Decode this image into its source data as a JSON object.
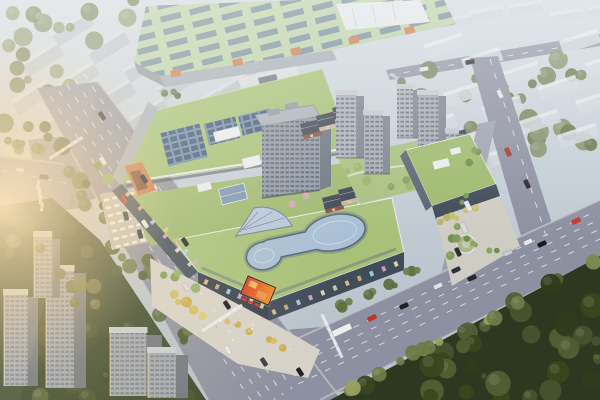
{
  "meta": {
    "description": "Aerial architectural rendering of a mixed-use commercial complex: green-roofed shopping mall with rooftop solar arrays and curved glass skylight, mid-rise residential towers, European-style retail street, tree-lined avenues with traffic, industrial building behind, hazy city blocks in the distance, dense forest in the foreground and warm sun flare from the left",
    "width": 600,
    "height": 400
  },
  "colors": {
    "sky_top": "#ced7df",
    "sky_bottom": "#b5bfc7",
    "road": "#8d90a0",
    "lane_mark": "#eef0f3",
    "sidewalk": "#c2c5cd",
    "mall_green": "#a2be72",
    "mall_green2": "#a7c178",
    "mall_green3": "#9db86e",
    "factory_green": "#b8cfa3",
    "solar_dark": "#2f4866",
    "glass": "#a9bfd4",
    "glass_frame": "#55667c",
    "facade_dark": "#38414d",
    "facade_mid": "#454f5c",
    "facade_light": "#9fa9b1",
    "accent_orange": "#c9774a",
    "led_red": "#d8401f",
    "led_orange": "#e98f2e",
    "led_text": "#d93425",
    "tower_face": "#8f98a4",
    "tower_side": "#6c7480",
    "tower_roof": "#a8afb8",
    "window": "#525a68",
    "bg_slab": "#b6c0c8",
    "bg_slab_top": "#d4dbe1",
    "bg_slab_tr": "#cfd7dd",
    "forest_base": "#2d3820",
    "bl_base": "#39462a",
    "plaza": "#d6d2c8",
    "plaza_east": "#cfccc3",
    "parking": "#c4bfb4",
    "podium_green": "#9cb96d",
    "courtyard": "#a9bf80",
    "brick": "#8a4f47",
    "slate": "#3e4553",
    "cream": "#c3b7a4",
    "pink": "#d4a4be",
    "wall": "#c6cdd3",
    "white_bldg": "#e0e4e7",
    "connector": "#d6dadd",
    "service": "#a7afb7",
    "flare": "#ffe6b8",
    "et_face": "#adb2ba",
    "et_side": "#7e848d",
    "et_top": "#c2c7cd",
    "blt_face": "#a2a8b0",
    "blt_side": "#6e747d",
    "blt_top": "#c9cdd2"
  },
  "solar_arrays": [
    [
      164,
      128,
      40,
      34
    ],
    [
      206,
      120,
      32,
      22
    ],
    [
      240,
      112,
      32,
      20
    ]
  ],
  "factory_accents": [
    [
      170,
      71
    ],
    [
      232,
      60
    ],
    [
      290,
      49
    ],
    [
      348,
      38
    ],
    [
      404,
      28
    ]
  ],
  "bg_slabs_tl": [
    [
      52,
      36
    ],
    [
      88,
      54
    ],
    [
      124,
      72
    ],
    [
      158,
      90
    ],
    [
      22,
      66
    ],
    [
      58,
      86
    ],
    [
      94,
      104
    ],
    [
      128,
      122
    ],
    [
      12,
      104
    ],
    [
      46,
      124
    ],
    [
      82,
      142
    ],
    [
      116,
      160
    ],
    [
      152,
      56
    ],
    [
      186,
      74
    ],
    [
      190,
      108
    ],
    [
      222,
      124
    ],
    [
      218,
      92
    ],
    [
      164,
      140
    ]
  ],
  "bg_slabs_tr": [
    [
      424,
      48
    ],
    [
      462,
      62
    ],
    [
      500,
      76
    ],
    [
      538,
      90
    ],
    [
      576,
      104
    ],
    [
      444,
      96
    ],
    [
      482,
      110
    ],
    [
      520,
      124
    ],
    [
      558,
      138
    ],
    [
      416,
      128
    ],
    [
      452,
      142
    ],
    [
      490,
      156
    ],
    [
      586,
      66
    ],
    [
      560,
      44
    ]
  ],
  "bg_slabs_far": [
    [
      470,
      14
    ],
    [
      510,
      8
    ],
    [
      550,
      16
    ],
    [
      588,
      10
    ],
    [
      440,
      22
    ]
  ],
  "bl_towers": [
    {
      "x": 4,
      "y": 294,
      "w": 34,
      "h": 92
    },
    {
      "x": 46,
      "y": 270,
      "w": 40,
      "h": 118
    },
    {
      "x": 110,
      "y": 332,
      "w": 52,
      "h": 64
    },
    {
      "x": 34,
      "y": 236,
      "w": 26,
      "h": 62
    },
    {
      "x": 148,
      "y": 352,
      "w": 40,
      "h": 46
    }
  ],
  "east_towers": [
    {
      "x": 336,
      "y": 94,
      "w": 28,
      "h": 64
    },
    {
      "x": 364,
      "y": 114,
      "w": 26,
      "h": 60
    },
    {
      "x": 397,
      "y": 88,
      "w": 22,
      "h": 50
    },
    {
      "x": 418,
      "y": 94,
      "w": 28,
      "h": 62
    },
    {
      "x": 446,
      "y": 132,
      "w": 18,
      "h": 44
    }
  ],
  "euro_retail": [
    [
      300,
      124
    ],
    [
      316,
      116
    ],
    [
      332,
      108
    ],
    [
      322,
      198
    ],
    [
      338,
      190
    ],
    [
      352,
      182
    ],
    [
      368,
      174
    ],
    [
      384,
      166
    ],
    [
      400,
      158
    ],
    [
      416,
      150
    ],
    [
      432,
      142
    ],
    [
      446,
      134
    ]
  ],
  "pink_trees": [
    [
      348,
      172
    ],
    [
      364,
      162
    ],
    [
      382,
      154
    ],
    [
      292,
      204
    ],
    [
      306,
      196
    ]
  ],
  "storefronts": {
    "palette": [
      "#e4c98c",
      "#d8b478",
      "#a8d4e4",
      "#d8a8c8",
      "#f0e2b0",
      "#c8e0b0"
    ],
    "rows": [
      {
        "x1": 206,
        "y1": 282,
        "x2": 262,
        "y2": 306,
        "n": 6
      },
      {
        "x1": 274,
        "y1": 312,
        "x2": 396,
        "y2": 264,
        "n": 11
      },
      {
        "x1": 128,
        "y1": 194,
        "x2": 190,
        "y2": 264,
        "n": 6
      },
      {
        "x1": 440,
        "y1": 213,
        "x2": 492,
        "y2": 193,
        "n": 6
      },
      {
        "x1": 166,
        "y1": 230,
        "x2": 196,
        "y2": 262,
        "n": 4
      }
    ]
  },
  "zebras": [
    {
      "cx": 222,
      "cy": 318,
      "len": 50,
      "band": -33,
      "stripe": 57,
      "sh": 11
    },
    {
      "cx": 332,
      "cy": 336,
      "len": 46,
      "band": 65,
      "stripe": -25,
      "sh": 11
    },
    {
      "cx": 66,
      "cy": 148,
      "len": 44,
      "band": -33,
      "stripe": 57,
      "sh": 10
    },
    {
      "cx": 40,
      "cy": 196,
      "len": 32,
      "band": 80,
      "stripe": 8,
      "sh": 9
    }
  ],
  "plaza_specks": {
    "poly": [
      [
        160,
        268
      ],
      [
        264,
        318
      ],
      [
        308,
        356
      ],
      [
        300,
        372
      ],
      [
        240,
        360
      ],
      [
        158,
        304
      ]
    ],
    "count": 14,
    "palette": [
      "#f2f2f0",
      "#e8e4dc",
      "#caa36a"
    ],
    "seed": 77
  },
  "cars": [
    {
      "x": 102,
      "y": 116,
      "a": 57,
      "c": "#23262b"
    },
    {
      "x": 103,
      "y": 161,
      "a": 57,
      "c": "#e8eaec"
    },
    {
      "x": 124,
      "y": 199,
      "a": 57,
      "c": "#c0392e"
    },
    {
      "x": 144,
      "y": 179,
      "a": 57,
      "c": "#1d2025"
    },
    {
      "x": 145,
      "y": 224,
      "a": 57,
      "c": "#e9ebed"
    },
    {
      "x": 185,
      "y": 242,
      "a": 57,
      "c": "#24272c"
    },
    {
      "x": 186,
      "y": 287,
      "a": 57,
      "c": "#d9dbde"
    },
    {
      "x": 227,
      "y": 305,
      "a": 57,
      "c": "#17191d"
    },
    {
      "x": 228,
      "y": 350,
      "a": 57,
      "c": "#e5e7e9"
    },
    {
      "x": 264,
      "y": 362,
      "a": 57,
      "c": "#3a3e45"
    },
    {
      "x": 300,
      "y": 372,
      "a": 57,
      "c": "#20242a"
    },
    {
      "x": 342,
      "y": 330,
      "a": -25,
      "c": "#eceef0",
      "w": 20,
      "h": 6.5
    },
    {
      "x": 372,
      "y": 318,
      "a": -25,
      "c": "#c23527"
    },
    {
      "x": 404,
      "y": 306,
      "a": -25,
      "c": "#1d2024"
    },
    {
      "x": 438,
      "y": 286,
      "a": -25,
      "c": "#e0e2e5"
    },
    {
      "x": 472,
      "y": 278,
      "a": -25,
      "c": "#24272d"
    },
    {
      "x": 508,
      "y": 253,
      "a": -25,
      "c": "#c7cace"
    },
    {
      "x": 542,
      "y": 244,
      "a": -25,
      "c": "#181b20"
    },
    {
      "x": 576,
      "y": 221,
      "a": -25,
      "c": "#d23227"
    },
    {
      "x": 456,
      "y": 270,
      "a": -25,
      "c": "#2c3037"
    },
    {
      "x": 528,
      "y": 242,
      "a": -25,
      "c": "#e7e9eb"
    },
    {
      "x": 20,
      "y": 170,
      "a": 8,
      "c": "#dadce0"
    },
    {
      "x": 44,
      "y": 177,
      "a": 8,
      "c": "#212429"
    },
    {
      "x": 424,
      "y": 69,
      "a": -10,
      "c": "#dee0e3"
    },
    {
      "x": 470,
      "y": 62,
      "a": -10,
      "c": "#2b2e34"
    },
    {
      "x": 500,
      "y": 94,
      "a": 64,
      "c": "#e0e2e4"
    },
    {
      "x": 508,
      "y": 152,
      "a": 64,
      "c": "#b23228"
    },
    {
      "x": 527,
      "y": 184,
      "a": 64,
      "c": "#24272c"
    },
    {
      "x": 468,
      "y": 206,
      "a": 64,
      "c": "#e3e5e7",
      "w": 11,
      "h": 5
    },
    {
      "x": 464,
      "y": 228,
      "a": 64,
      "c": "#d8dadd",
      "w": 11,
      "h": 5
    },
    {
      "x": 458,
      "y": 252,
      "a": 64,
      "c": "#2d3138"
    },
    {
      "x": 126,
      "y": 216,
      "a": 76,
      "c": "#33373d"
    },
    {
      "x": 140,
      "y": 234,
      "a": 76,
      "c": "#2a2e33"
    }
  ],
  "vegetation": [
    {
      "name": "forest-bottom-right",
      "layer": "veg-forest",
      "poly": [
        [
          330,
          400
        ],
        [
          600,
          256
        ],
        [
          600,
          400
        ]
      ],
      "count": 36,
      "rmin": 5,
      "rmax": 13,
      "palette": [
        "#46542e",
        "#39471f",
        "#515f35",
        "#2f3b1d"
      ],
      "seed": 11
    },
    {
      "name": "forest-edge-highlight",
      "layer": "veg-forest-edge",
      "line": [
        342,
        394,
        594,
        262
      ],
      "spread": 7,
      "count": 13,
      "rmin": 4,
      "rmax": 8,
      "palette": [
        "#6d7c48",
        "#7d8a52",
        "#98a061"
      ],
      "seed": 12
    },
    {
      "name": "trees-bottom-left",
      "layer": "veg-bl",
      "poly": [
        [
          0,
          206
        ],
        [
          52,
          198
        ],
        [
          100,
          240
        ],
        [
          206,
          400
        ],
        [
          0,
          400
        ]
      ],
      "count": 32,
      "rmin": 5,
      "rmax": 12,
      "palette": [
        "#42502c",
        "#36431f",
        "#4e5c33",
        "#57633a"
      ],
      "seed": 13
    },
    {
      "name": "trees-bl-warmlit",
      "layer": "veg-bl-warm",
      "line": [
        10,
        230,
        120,
        330
      ],
      "spread": 16,
      "count": 8,
      "rmin": 4,
      "rmax": 8,
      "palette": [
        "#6a7040",
        "#7a7c46"
      ],
      "seed": 14
    },
    {
      "name": "trees-west-road-west",
      "layer": "veg-road-bands",
      "line": [
        30,
        118,
        196,
        346
      ],
      "spread": 13,
      "count": 26,
      "rmin": 4,
      "rmax": 9,
      "palette": [
        "#55663c",
        "#47552e",
        "#63744a"
      ],
      "seed": 15
    },
    {
      "name": "trees-west-road-east",
      "layer": "veg-road-bands",
      "line": [
        92,
        158,
        148,
        236
      ],
      "spread": 6,
      "count": 9,
      "rmin": 3,
      "rmax": 6,
      "palette": [
        "#7c9a54",
        "#8fae62",
        "#6b8a46"
      ],
      "seed": 16
    },
    {
      "name": "trees-branch-north",
      "layer": "veg-road-bands",
      "line": [
        4,
        146,
        58,
        152
      ],
      "spread": 7,
      "count": 7,
      "rmin": 3,
      "rmax": 6,
      "palette": [
        "#5c6c42",
        "#6d7e50"
      ],
      "seed": 17
    },
    {
      "name": "trees-top-right-olive",
      "layer": "veg-tr",
      "poly": [
        [
          388,
          76
        ],
        [
          596,
          40
        ],
        [
          596,
          186
        ],
        [
          398,
          100
        ]
      ],
      "count": 26,
      "rmin": 4,
      "rmax": 10,
      "palette": [
        "#75825c",
        "#83906a",
        "#67744d"
      ],
      "seed": 18
    },
    {
      "name": "trees-top-left",
      "layer": "veg-tl",
      "poly": [
        [
          0,
          0
        ],
        [
          150,
          0
        ],
        [
          118,
          52
        ],
        [
          36,
          122
        ],
        [
          0,
          140
        ]
      ],
      "count": 20,
      "rmin": 4,
      "rmax": 10,
      "palette": [
        "#7b8a64",
        "#6a7a52",
        "#8a9771"
      ],
      "seed": 19
    },
    {
      "name": "trees-factory-south",
      "layer": "veg-factory",
      "line": [
        150,
        90,
        250,
        104
      ],
      "spread": 5,
      "count": 8,
      "rmin": 3,
      "rmax": 5,
      "palette": [
        "#5e7046",
        "#4f6038"
      ],
      "seed": 20
    },
    {
      "name": "trees-south-road-north",
      "layer": "veg-front",
      "line": [
        332,
        310,
        424,
        266
      ],
      "spread": 6,
      "count": 10,
      "rmin": 3,
      "rmax": 6,
      "palette": [
        "#5e7040",
        "#6f8150",
        "#8a9456"
      ],
      "seed": 21
    },
    {
      "name": "trees-plaza-yellow",
      "layer": "veg-plaza",
      "line": [
        172,
        298,
        296,
        352
      ],
      "spread": 7,
      "count": 12,
      "rmin": 3,
      "rmax": 6,
      "palette": [
        "#d2bd5e",
        "#c9ad4b",
        "#ddc973"
      ],
      "seed": 22
    },
    {
      "name": "trees-east-street",
      "layer": "veg-front",
      "line": [
        478,
        140,
        448,
        262
      ],
      "spread": 5,
      "count": 9,
      "rmin": 2.5,
      "rmax": 4.5,
      "palette": [
        "#6d8a4c",
        "#7d9a58"
      ],
      "seed": 23
    },
    {
      "name": "trees-podium-edge",
      "layer": "veg-front",
      "line": [
        436,
        224,
        496,
        200
      ],
      "spread": 4,
      "count": 7,
      "rmin": 2.5,
      "rmax": 4,
      "palette": [
        "#b4b264",
        "#c4bf6e"
      ],
      "seed": 24
    },
    {
      "name": "trees-ne-road",
      "layer": "veg-tr",
      "line": [
        472,
        72,
        534,
        206
      ],
      "spread": 9,
      "count": 10,
      "rmin": 3,
      "rmax": 7,
      "palette": [
        "#75825c",
        "#67744d"
      ],
      "seed": 25
    },
    {
      "name": "trees-courtyard",
      "layer": "veg-courtyard",
      "poly": [
        [
          340,
          160
        ],
        [
          418,
          142
        ],
        [
          440,
          182
        ],
        [
          362,
          202
        ]
      ],
      "count": 8,
      "rmin": 2.5,
      "rmax": 4.5,
      "palette": [
        "#7fa055",
        "#93b366"
      ],
      "seed": 26
    },
    {
      "name": "trees-east-plaza",
      "layer": "veg-front",
      "line": [
        452,
        236,
        504,
        254
      ],
      "spread": 6,
      "count": 5,
      "rmin": 2.5,
      "rmax": 4,
      "palette": [
        "#6d8a4c",
        "#86a45c"
      ],
      "seed": 27
    },
    {
      "name": "trees-sw-plaza-green",
      "layer": "veg-plaza",
      "line": [
        156,
        266,
        200,
        292
      ],
      "spread": 5,
      "count": 4,
      "rmin": 3,
      "rmax": 5,
      "palette": [
        "#7c9a54",
        "#8fae62"
      ],
      "seed": 28
    }
  ]
}
